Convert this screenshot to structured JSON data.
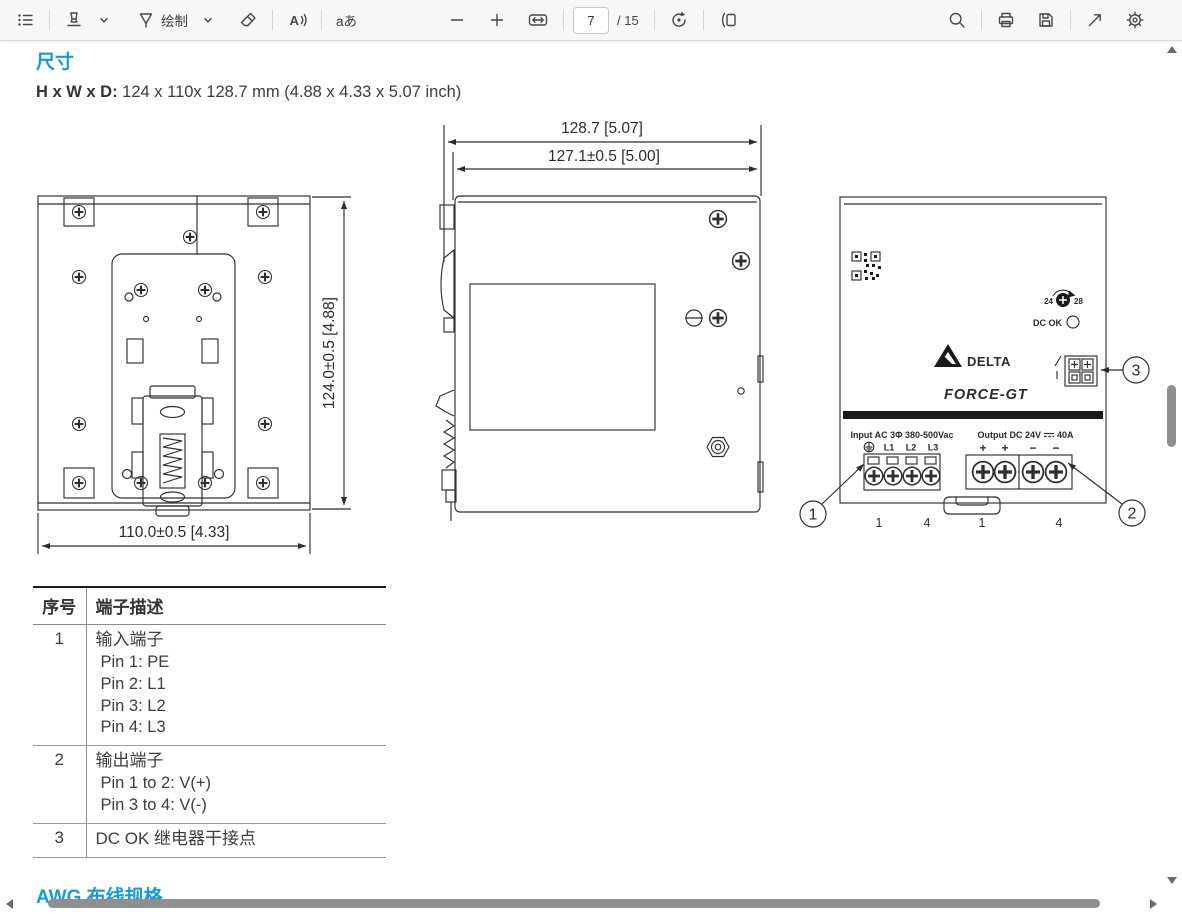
{
  "toolbar": {
    "draw_label": "绘制",
    "text_tool_label": "aあ",
    "page_number": "7",
    "page_count_label": "/ 15"
  },
  "document": {
    "section_title": "尺寸",
    "dims_bold": "H x W x D:",
    "dims_rest": " 124 x 110x 128.7 mm (4.88 x 4.33 x 5.07 inch)",
    "next_section_title": "AWG 布线规格"
  },
  "drawings": {
    "rear_view": {
      "height_dim": "124.0±0.5  [4.88]",
      "width_dim": "110.0±0.5  [4.33]"
    },
    "side_view": {
      "outer_depth_dim": "128.7  [5.07]",
      "inner_depth_dim": "127.1±0.5  [5.00]"
    },
    "front_view": {
      "brand": "DELTA",
      "model": "FORCE-GT",
      "pot_left": "24",
      "pot_right": "28",
      "dc_ok_label": "DC OK",
      "input_label": "Input AC 3Φ 380-500Vac",
      "input_pin_l1": "L1",
      "input_pin_l2": "L2",
      "input_pin_l3": "L3",
      "output_label_left": "Output DC 24V",
      "output_label_right": "40A",
      "plus1": "+",
      "plus2": "+",
      "minus1": "−",
      "minus2": "−",
      "callout_1": "1",
      "callout_2": "2",
      "callout_3": "3",
      "pin_no_1": "1",
      "pin_no_2": "4",
      "pin_no_3": "1",
      "pin_no_4": "4"
    }
  },
  "table": {
    "headers": [
      "序号",
      "端子描述"
    ],
    "rows": [
      {
        "num": "1",
        "title": "输入端子",
        "lines": [
          "Pin 1: PE",
          "Pin 2: L1",
          "Pin 3: L2",
          "Pin 4: L3"
        ]
      },
      {
        "num": "2",
        "title": "输出端子",
        "lines": [
          "Pin 1 to 2: V(+)",
          "Pin 3 to 4: V(-)"
        ]
      },
      {
        "num": "3",
        "title": "DC OK 继电器干接点",
        "lines": []
      }
    ]
  },
  "colors": {
    "accent_blue": "#169bd5",
    "body_text": "#3c3c3c",
    "scroll_thumb": "#8f8f8f"
  }
}
